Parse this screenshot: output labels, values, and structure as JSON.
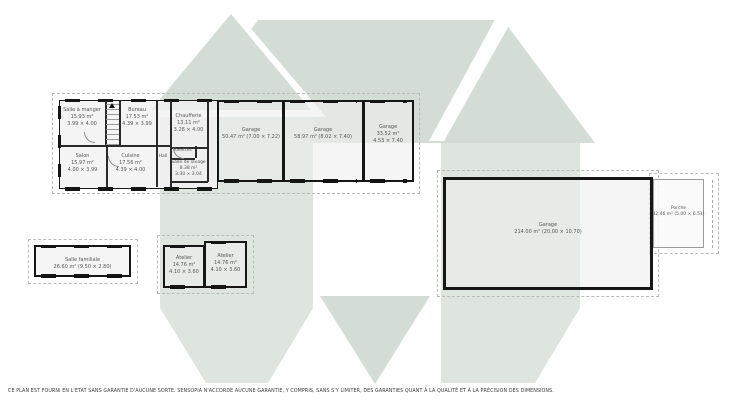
{
  "plan": {
    "rooms": {
      "salle_a_manger": {
        "lines": [
          "Salle à manger",
          "15.93 m²",
          "3.99 × 4.00"
        ]
      },
      "bureau": {
        "lines": [
          "Bureau",
          "17.53 m²",
          "4.39 × 3.99"
        ]
      },
      "chaufferie": {
        "lines": [
          "Chaufferie",
          "13.11 m²",
          "3.28 × 4.00"
        ]
      },
      "toilettes": {
        "lines": [
          "Toilettes"
        ]
      },
      "salle_de_lavage": {
        "lines": [
          "Salle de lavage",
          "8.38 m²",
          "3.30 × 3.04"
        ]
      },
      "salon": {
        "lines": [
          "Salon",
          "15.97 m²",
          "4.00 × 3.99"
        ]
      },
      "cuisine": {
        "lines": [
          "Cuisine",
          "17.56 m²",
          "4.39 × 4.00"
        ]
      },
      "hall": {
        "lines": [
          "Hall"
        ]
      },
      "garage_1": {
        "lines": [
          "Garage",
          "50.47 m² (7.00 × 7.22)"
        ]
      },
      "garage_2": {
        "lines": [
          "Garage",
          "58.97 m² (8.02 × 7.40)"
        ]
      },
      "garage_3": {
        "lines": [
          "Garage",
          "33.52 m²",
          "4.53 × 7.40"
        ]
      },
      "salle_familiale": {
        "lines": [
          "Salle familiale",
          "26.60 m² (9.50 × 2.80)"
        ]
      },
      "atelier_gauche": {
        "lines": [
          "Atelier",
          "14.76 m²",
          "4.10 × 3.60"
        ]
      },
      "atelier_droit": {
        "lines": [
          "Atelier",
          "14.76 m²",
          "4.10 × 3.60"
        ]
      },
      "grand_garage": {
        "lines": [
          "Garage",
          "214.00 m² (20.00 × 10.70)"
        ]
      },
      "porche": {
        "lines": [
          "Porche",
          "32.46 m² (5.00 × 6.51)"
        ]
      }
    },
    "disclaimer": "CE PLAN EST FOURNI EN L'ETAT SANS GARANTIE D'AUCUNE SORTE. SENSOPIA N'ACCORDE AUCUNE GARANTIE, Y COMPRIS, SANS S'Y LIMITER, DES GARANTIES QUANT À LA QUALITÉ ET À LA PRÉCISION DES DIMENSIONS.",
    "colors": {
      "watermark_light": "#dee5df",
      "watermark_mid": "#d3dcd5",
      "wall": "#161616",
      "label_text": "#565656"
    }
  }
}
